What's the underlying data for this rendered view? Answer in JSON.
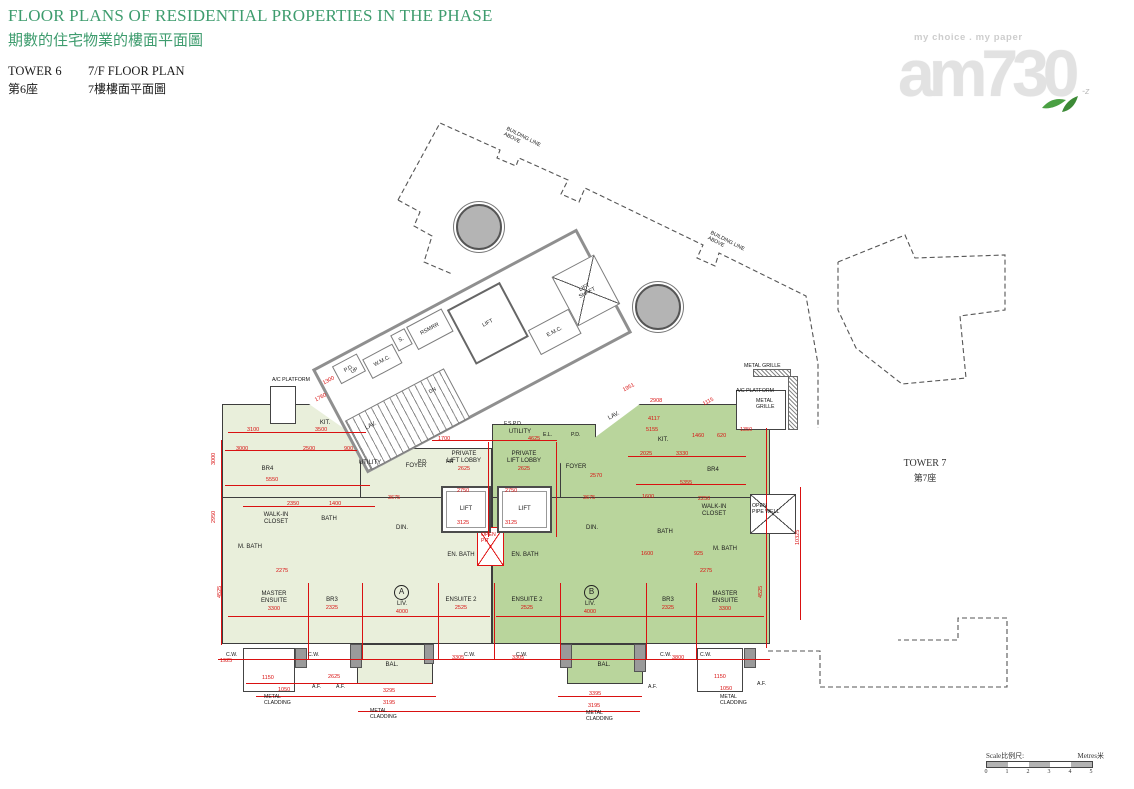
{
  "header": {
    "title_en": "FLOOR PLANS OF RESIDENTIAL PROPERTIES IN THE PHASE",
    "title_zh": "期數的住宅物業的樓面平面圖",
    "tower_en": "TOWER 6",
    "tower_zh": "第6座",
    "floor_en": "7/F FLOOR PLAN",
    "floor_zh": "7樓樓面平面圖",
    "accent_color": "#3e9c6e"
  },
  "logo": {
    "tagline": "my choice . my paper",
    "wordmark": "am730"
  },
  "tower7": {
    "en": "TOWER 7",
    "zh": "第7座"
  },
  "scalebar": {
    "label_left": "Scale比例尺:",
    "label_right": "Metres米",
    "ticks": [
      "0",
      "1",
      "2",
      "3",
      "4",
      "5"
    ],
    "segments": 5
  },
  "plan": {
    "colors": {
      "unit_a": "#e9efdb",
      "unit_b": "#b9d59c",
      "dim_red": "#d91111",
      "wall": "#3d3d3d",
      "core_gray": "#8f8f8f"
    },
    "dashed_paths": [
      "M398,200 L440,123 L500,150 L497,158 L516,166 L519,158 L568,180 L561,194 L579,202 L585,188 L703,245 L697,258 L715,266 L719,253 L806,296 L818,364 L818,428",
      "M398,200 L420,212 L414,226 L432,236 L424,262 L452,274",
      "M838,262 L905,235 L915,258 L1005,255 L1005,310 L960,316 L966,378 L902,384 L856,348 L838,310 L838,262",
      "M768,651 L820,651 L820,687 L1007,687 L1007,618 L958,618 L958,640 L898,640"
    ],
    "circles": [
      {
        "x": 477,
        "y": 225,
        "r": 21
      },
      {
        "x": 656,
        "y": 305,
        "r": 21
      }
    ],
    "unit_shapes": [
      {
        "u": "a",
        "x": 222,
        "y": 404,
        "w": 150,
        "h": 96,
        "c": "polygon(0 0, 58% 0, 100% 46%, 100% 100%, 0 100%)"
      },
      {
        "u": "a",
        "x": 360,
        "y": 448,
        "w": 132,
        "h": 52
      },
      {
        "u": "a",
        "x": 222,
        "y": 497,
        "w": 270,
        "h": 147
      },
      {
        "u": "a",
        "x": 357,
        "y": 644,
        "w": 76,
        "h": 40
      },
      {
        "u": "b",
        "x": 492,
        "y": 424,
        "w": 104,
        "h": 76
      },
      {
        "u": "b",
        "x": 560,
        "y": 404,
        "w": 210,
        "h": 96,
        "c": "polygon(38% 0, 100% 0, 100% 100%, 0 100%, 0 62%)"
      },
      {
        "u": "b",
        "x": 492,
        "y": 497,
        "w": 278,
        "h": 147
      },
      {
        "u": "b",
        "x": 567,
        "y": 644,
        "w": 76,
        "h": 40
      }
    ],
    "bays": [
      {
        "x": 243,
        "y": 648,
        "w": 52,
        "h": 44
      },
      {
        "x": 697,
        "y": 648,
        "w": 46,
        "h": 44
      },
      {
        "x": 270,
        "y": 386,
        "w": 26,
        "h": 38
      },
      {
        "x": 736,
        "y": 390,
        "w": 50,
        "h": 40
      }
    ],
    "xboxes": [
      {
        "x": 750,
        "y": 494,
        "w": 46,
        "h": 40,
        "red": false
      },
      {
        "x": 477,
        "y": 527,
        "w": 27,
        "h": 39,
        "red": true
      }
    ],
    "piers": [
      {
        "x": 350,
        "y": 644,
        "w": 12,
        "h": 24
      },
      {
        "x": 424,
        "y": 644,
        "w": 10,
        "h": 20
      },
      {
        "x": 560,
        "y": 644,
        "w": 12,
        "h": 24
      },
      {
        "x": 634,
        "y": 644,
        "w": 12,
        "h": 28
      },
      {
        "x": 295,
        "y": 648,
        "w": 12,
        "h": 20
      },
      {
        "x": 744,
        "y": 648,
        "w": 12,
        "h": 20
      }
    ],
    "hatches": [
      {
        "x": 753,
        "y": 369,
        "w": 38,
        "h": 8
      },
      {
        "x": 788,
        "y": 376,
        "w": 10,
        "h": 54
      }
    ],
    "core": {
      "x": 322,
      "y": 292,
      "w": 300,
      "h": 118,
      "rot": -28,
      "rooms": [
        {
          "l": "",
          "x": 2,
          "y": 58,
          "w": 112,
          "h": 56,
          "t": "stairs"
        },
        {
          "l": "P.D.",
          "x": 16,
          "y": 4,
          "w": 28,
          "h": 20
        },
        {
          "l": "W.M.C.",
          "x": 46,
          "y": 12,
          "w": 34,
          "h": 22
        },
        {
          "l": "S.",
          "x": 82,
          "y": 4,
          "w": 16,
          "h": 18
        },
        {
          "l": "RSMRR",
          "x": 100,
          "y": 4,
          "w": 40,
          "h": 26
        },
        {
          "l": "LIFT",
          "x": 144,
          "y": 8,
          "w": 60,
          "h": 62,
          "t": "liftbox"
        },
        {
          "l": "E.M.C.",
          "x": 206,
          "y": 64,
          "w": 46,
          "h": 28
        },
        {
          "l": "LIFT\nSHAFT",
          "x": 252,
          "y": 28,
          "w": 48,
          "h": 56,
          "t": "shaft"
        }
      ]
    },
    "rooms": [
      {
        "l": "KIT.",
        "x": 300,
        "y": 412,
        "w": 50,
        "h": 22
      },
      {
        "l": "BR4",
        "x": 240,
        "y": 460,
        "w": 55,
        "h": 18
      },
      {
        "l": "LAV.",
        "x": 356,
        "y": 420,
        "w": 30,
        "h": 12,
        "r": -28
      },
      {
        "l": "UTILITY",
        "x": 348,
        "y": 457,
        "w": 44,
        "h": 13
      },
      {
        "l": "FOYER",
        "x": 396,
        "y": 460,
        "w": 40,
        "h": 13
      },
      {
        "l": "PRIVATE\nLIFT LOBBY",
        "x": 436,
        "y": 450,
        "w": 56,
        "h": 24,
        "s": "2625"
      },
      {
        "l": "WALK-IN\nCLOSET",
        "x": 248,
        "y": 508,
        "w": 56,
        "h": 22
      },
      {
        "l": "BATH",
        "x": 312,
        "y": 512,
        "w": 34,
        "h": 14
      },
      {
        "l": "M. BATH",
        "x": 228,
        "y": 540,
        "w": 44,
        "h": 14
      },
      {
        "l": "DIN.",
        "x": 382,
        "y": 520,
        "w": 40,
        "h": 16
      },
      {
        "l": "EN. BATH",
        "x": 436,
        "y": 548,
        "w": 50,
        "h": 14
      },
      {
        "l": "MASTER\nENSUITE",
        "x": 244,
        "y": 590,
        "w": 60,
        "h": 24,
        "s": "3300"
      },
      {
        "l": "BR3",
        "x": 312,
        "y": 596,
        "w": 40,
        "h": 16,
        "s": "2325"
      },
      {
        "l": "LIV.",
        "x": 382,
        "y": 600,
        "w": 40,
        "h": 16,
        "s": "4000"
      },
      {
        "l": "ENSUITE 2",
        "x": 434,
        "y": 596,
        "w": 54,
        "h": 16,
        "s": "2525"
      },
      {
        "l": "BAL.",
        "x": 362,
        "y": 658,
        "w": 60,
        "h": 14
      },
      {
        "l": "UTILITY",
        "x": 498,
        "y": 426,
        "w": 44,
        "h": 13
      },
      {
        "l": "LAV.",
        "x": 600,
        "y": 410,
        "w": 28,
        "h": 12,
        "r": -28
      },
      {
        "l": "FOYER",
        "x": 556,
        "y": 461,
        "w": 40,
        "h": 13
      },
      {
        "l": "PRIVATE\nLIFT LOBBY",
        "x": 496,
        "y": 450,
        "w": 56,
        "h": 24,
        "s": "2625"
      },
      {
        "l": "KIT.",
        "x": 638,
        "y": 432,
        "w": 50,
        "h": 16
      },
      {
        "l": "BR4",
        "x": 688,
        "y": 462,
        "w": 50,
        "h": 16
      },
      {
        "l": "EN. BATH",
        "x": 500,
        "y": 548,
        "w": 50,
        "h": 14
      },
      {
        "l": "DIN.",
        "x": 572,
        "y": 520,
        "w": 40,
        "h": 16
      },
      {
        "l": "BATH",
        "x": 648,
        "y": 525,
        "w": 34,
        "h": 14
      },
      {
        "l": "WALK-IN\nCLOSET",
        "x": 686,
        "y": 500,
        "w": 56,
        "h": 22
      },
      {
        "l": "M. BATH",
        "x": 702,
        "y": 542,
        "w": 46,
        "h": 14
      },
      {
        "l": "LIV.",
        "x": 570,
        "y": 600,
        "w": 40,
        "h": 16,
        "s": "4000"
      },
      {
        "l": "ENSUITE 2",
        "x": 500,
        "y": 596,
        "w": 54,
        "h": 16,
        "s": "2525"
      },
      {
        "l": "BR3",
        "x": 648,
        "y": 596,
        "w": 40,
        "h": 16,
        "s": "2325"
      },
      {
        "l": "MASTER\nENSUITE",
        "x": 694,
        "y": 590,
        "w": 62,
        "h": 24,
        "s": "3300"
      },
      {
        "l": "BAL.",
        "x": 574,
        "y": 658,
        "w": 60,
        "h": 14
      },
      {
        "l": "LIFT",
        "x": 441,
        "y": 486,
        "w": 50,
        "h": 47,
        "t": "lift"
      },
      {
        "l": "LIFT",
        "x": 497,
        "y": 486,
        "w": 55,
        "h": 47,
        "t": "lift"
      }
    ],
    "badges": [
      {
        "t": "A",
        "x": 394,
        "y": 585
      },
      {
        "t": "B",
        "x": 584,
        "y": 585
      }
    ],
    "dims": [
      {
        "t": "3100",
        "x": 247,
        "y": 427
      },
      {
        "t": "3500",
        "x": 315,
        "y": 427
      },
      {
        "t": "3000",
        "x": 236,
        "y": 446
      },
      {
        "t": "2500",
        "x": 303,
        "y": 446
      },
      {
        "t": "900",
        "x": 344,
        "y": 446
      },
      {
        "t": "5550",
        "x": 266,
        "y": 477
      },
      {
        "t": "2350",
        "x": 287,
        "y": 501
      },
      {
        "t": "1400",
        "x": 329,
        "y": 501
      },
      {
        "t": "3675",
        "x": 388,
        "y": 495
      },
      {
        "t": "1700",
        "x": 438,
        "y": 436
      },
      {
        "t": "4625",
        "x": 528,
        "y": 436
      },
      {
        "t": "2750",
        "x": 457,
        "y": 488
      },
      {
        "t": "2750",
        "x": 505,
        "y": 488
      },
      {
        "t": "3125",
        "x": 457,
        "y": 520
      },
      {
        "t": "3125",
        "x": 505,
        "y": 520
      },
      {
        "t": "1951",
        "x": 622,
        "y": 388,
        "r": -28
      },
      {
        "t": "2908",
        "x": 650,
        "y": 398
      },
      {
        "t": "1115",
        "x": 702,
        "y": 402,
        "r": -28
      },
      {
        "t": "4117",
        "x": 648,
        "y": 416
      },
      {
        "t": "5155",
        "x": 646,
        "y": 427
      },
      {
        "t": "1460",
        "x": 692,
        "y": 433
      },
      {
        "t": "620",
        "x": 717,
        "y": 433
      },
      {
        "t": "1350",
        "x": 740,
        "y": 427
      },
      {
        "t": "2025",
        "x": 640,
        "y": 451
      },
      {
        "t": "3330",
        "x": 676,
        "y": 451
      },
      {
        "t": "2570",
        "x": 590,
        "y": 473
      },
      {
        "t": "5355",
        "x": 680,
        "y": 480
      },
      {
        "t": "3675",
        "x": 583,
        "y": 495
      },
      {
        "t": "2250",
        "x": 698,
        "y": 496
      },
      {
        "t": "1600",
        "x": 642,
        "y": 494
      },
      {
        "t": "1600",
        "x": 641,
        "y": 551
      },
      {
        "t": "925",
        "x": 694,
        "y": 551
      },
      {
        "t": "2275",
        "x": 276,
        "y": 568
      },
      {
        "t": "2275",
        "x": 700,
        "y": 568
      },
      {
        "t": "1925",
        "x": 220,
        "y": 658
      },
      {
        "t": "3305",
        "x": 452,
        "y": 655
      },
      {
        "t": "3305",
        "x": 512,
        "y": 655
      },
      {
        "t": "3800",
        "x": 672,
        "y": 655
      },
      {
        "t": "1150",
        "x": 262,
        "y": 675
      },
      {
        "t": "1050",
        "x": 278,
        "y": 687
      },
      {
        "t": "2625",
        "x": 328,
        "y": 674
      },
      {
        "t": "3295",
        "x": 383,
        "y": 688
      },
      {
        "t": "3195",
        "x": 383,
        "y": 700
      },
      {
        "t": "3395",
        "x": 589,
        "y": 691
      },
      {
        "t": "3195",
        "x": 588,
        "y": 703
      },
      {
        "t": "1150",
        "x": 714,
        "y": 674
      },
      {
        "t": "1050",
        "x": 720,
        "y": 686
      },
      {
        "t": "3000",
        "x": 211,
        "y": 465,
        "r": -90
      },
      {
        "t": "2950",
        "x": 211,
        "y": 523,
        "r": -90
      },
      {
        "t": "4525",
        "x": 217,
        "y": 598,
        "r": -90
      },
      {
        "t": "4525",
        "x": 758,
        "y": 598,
        "r": -90
      },
      {
        "t": "10325",
        "x": 795,
        "y": 545,
        "r": -90
      },
      {
        "t": "1300",
        "x": 322,
        "y": 381,
        "r": -28
      },
      {
        "t": "1760",
        "x": 314,
        "y": 398,
        "r": -28
      }
    ],
    "dim_lines": [
      {
        "x": 228,
        "y": 432,
        "w": 138,
        "h": 1
      },
      {
        "x": 225,
        "y": 450,
        "w": 132,
        "h": 1
      },
      {
        "x": 225,
        "y": 485,
        "w": 145,
        "h": 1
      },
      {
        "x": 243,
        "y": 506,
        "w": 132,
        "h": 1
      },
      {
        "x": 432,
        "y": 440,
        "w": 125,
        "h": 1
      },
      {
        "x": 628,
        "y": 456,
        "w": 118,
        "h": 1
      },
      {
        "x": 636,
        "y": 484,
        "w": 110,
        "h": 1
      },
      {
        "x": 228,
        "y": 616,
        "w": 262,
        "h": 1
      },
      {
        "x": 496,
        "y": 616,
        "w": 268,
        "h": 1
      },
      {
        "x": 218,
        "y": 659,
        "w": 552,
        "h": 1
      },
      {
        "x": 246,
        "y": 683,
        "w": 186,
        "h": 1
      },
      {
        "x": 256,
        "y": 696,
        "w": 180,
        "h": 1
      },
      {
        "x": 358,
        "y": 711,
        "w": 282,
        "h": 1
      },
      {
        "x": 558,
        "y": 696,
        "w": 84,
        "h": 1
      },
      {
        "x": 221,
        "y": 440,
        "w": 1,
        "h": 205
      },
      {
        "x": 766,
        "y": 428,
        "w": 1,
        "h": 220
      },
      {
        "x": 800,
        "y": 487,
        "w": 1,
        "h": 133
      },
      {
        "x": 308,
        "y": 583,
        "w": 1,
        "h": 77
      },
      {
        "x": 362,
        "y": 583,
        "w": 1,
        "h": 77
      },
      {
        "x": 438,
        "y": 583,
        "w": 1,
        "h": 77
      },
      {
        "x": 494,
        "y": 583,
        "w": 1,
        "h": 77
      },
      {
        "x": 560,
        "y": 583,
        "w": 1,
        "h": 77
      },
      {
        "x": 646,
        "y": 583,
        "w": 1,
        "h": 77
      },
      {
        "x": 696,
        "y": 583,
        "w": 1,
        "h": 77
      },
      {
        "x": 488,
        "y": 442,
        "w": 1,
        "h": 95
      },
      {
        "x": 556,
        "y": 442,
        "w": 1,
        "h": 95
      }
    ],
    "annotations": [
      {
        "t": "BUILDING LINE\nABOVE",
        "x": 508,
        "y": 126,
        "r": 27
      },
      {
        "t": "BUILDING LINE\nABOVE",
        "x": 712,
        "y": 230,
        "r": 27
      },
      {
        "t": "METAL GRILLE",
        "x": 744,
        "y": 363
      },
      {
        "t": "A/C PLATFORM",
        "x": 736,
        "y": 388
      },
      {
        "t": "METAL\nGRILLE",
        "x": 756,
        "y": 398
      },
      {
        "t": "A/C PLATFORM",
        "x": 272,
        "y": 377
      },
      {
        "t": "METAL\nCLADDING",
        "x": 264,
        "y": 694
      },
      {
        "t": "METAL\nCLADDING",
        "x": 370,
        "y": 708
      },
      {
        "t": "METAL\nCLADDING",
        "x": 586,
        "y": 710
      },
      {
        "t": "METAL\nCLADDING",
        "x": 720,
        "y": 694
      },
      {
        "t": "A.F.",
        "x": 312,
        "y": 684
      },
      {
        "t": "A.F.",
        "x": 336,
        "y": 684
      },
      {
        "t": "A.F.",
        "x": 648,
        "y": 684
      },
      {
        "t": "A.F.",
        "x": 757,
        "y": 681
      },
      {
        "t": "C.W.",
        "x": 226,
        "y": 652
      },
      {
        "t": "C.W.",
        "x": 308,
        "y": 652
      },
      {
        "t": "C.W.",
        "x": 464,
        "y": 652
      },
      {
        "t": "C.W.",
        "x": 516,
        "y": 652
      },
      {
        "t": "C.W.",
        "x": 660,
        "y": 652
      },
      {
        "t": "C.W.",
        "x": 700,
        "y": 652
      },
      {
        "t": "HR",
        "x": 446,
        "y": 459
      },
      {
        "t": "P.D.",
        "x": 418,
        "y": 459
      },
      {
        "t": "P.D.",
        "x": 571,
        "y": 432
      },
      {
        "t": "E.L.",
        "x": 543,
        "y": 432
      },
      {
        "t": "F.S.P.D.",
        "x": 504,
        "y": 421
      },
      {
        "t": "OPEN\nPIT",
        "x": 481,
        "y": 532,
        "c": "#d91111"
      },
      {
        "t": "OPEN\nPIPE WELL",
        "x": 752,
        "y": 503
      },
      {
        "t": "UP",
        "x": 350,
        "y": 370,
        "r": -28
      },
      {
        "t": "DN",
        "x": 428,
        "y": 390,
        "r": -28
      }
    ]
  }
}
